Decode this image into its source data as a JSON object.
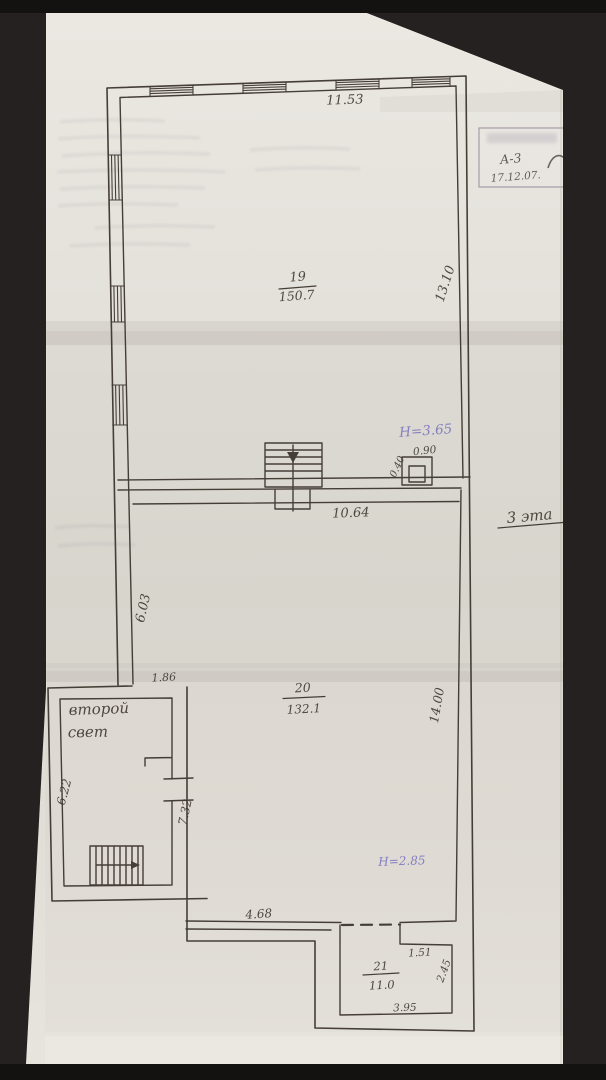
{
  "photo": {
    "background": "#1c1a19",
    "paper": "#e3e0da"
  },
  "ink": {
    "drawing": "#453e36",
    "notes_blue": "#7570bd"
  },
  "stamp": {
    "code": "А-3",
    "date": "17.12.07."
  },
  "annotations": {
    "floor_label": "3 эта",
    "second_light_line1": "второй",
    "second_light_line2": "свет",
    "height_upper": "Н=3.65",
    "height_lower": "Н=2.85"
  },
  "rooms": {
    "r19": {
      "number": "19",
      "area": "150.7"
    },
    "r20": {
      "number": "20",
      "area": "132.1"
    },
    "r21": {
      "number": "21",
      "area": "11.0"
    }
  },
  "dims": {
    "top_width": "11.53",
    "right_upper": "13.10",
    "inner_top": "10.64",
    "duct_width": "0.90",
    "duct_depth": "0.40",
    "left_mid": "6.03",
    "opening": "1.86",
    "right_mid": "14.00",
    "block_left": "6.22",
    "block_right": "7.32",
    "bottom_left": "4.68",
    "nook_top": "1.51",
    "nook_right": "2.45",
    "nook_bottom": "3.95"
  }
}
